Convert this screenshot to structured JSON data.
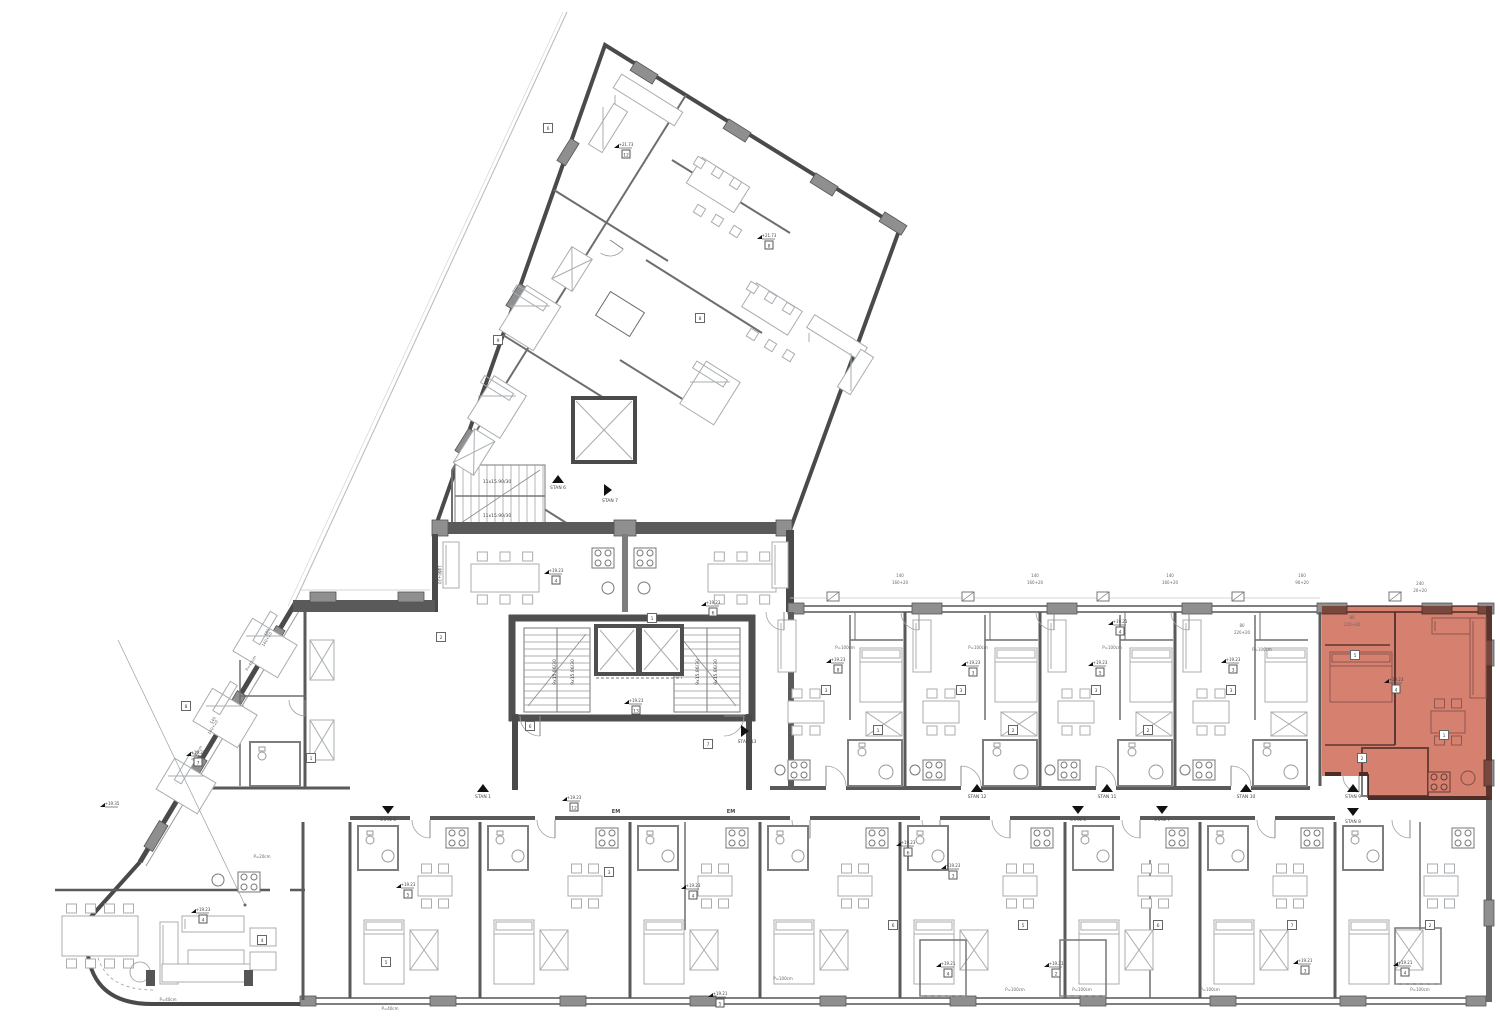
{
  "document": {
    "type": "architectural-floor-plan",
    "sheet_background": "#ffffff"
  },
  "colors": {
    "highlight_fill": "#cd6450",
    "wall_dark": "#4a4a4a",
    "wall_mid": "#6e6e6e",
    "pier_gray": "#8f8f8f",
    "furniture_line": "#a8adb1",
    "thin_line": "#9aa0a4",
    "text_color": "#444444"
  },
  "highlighted_unit": {
    "entry_label_up": "STAN 9",
    "entry_label_down": "STAN 8",
    "elevation": "+19.23",
    "room_box": "4"
  },
  "corridor_markers": [
    {
      "label": "STAN 3",
      "x": 388,
      "y": 806,
      "dir": "down"
    },
    {
      "label": "STAN 1",
      "x": 483,
      "y": 792,
      "dir": "up"
    },
    {
      "label": "STAN 13",
      "x": 741,
      "y": 731,
      "dir": "right"
    },
    {
      "label": "STAN 12",
      "x": 977,
      "y": 792,
      "dir": "up"
    },
    {
      "label": "STAN 5",
      "x": 1078,
      "y": 806,
      "dir": "down"
    },
    {
      "label": "STAN 11",
      "x": 1107,
      "y": 792,
      "dir": "up"
    },
    {
      "label": "STAN 7",
      "x": 1162,
      "y": 806,
      "dir": "down"
    },
    {
      "label": "STAN 10",
      "x": 1246,
      "y": 792,
      "dir": "up"
    },
    {
      "label": "STAN 9",
      "x": 1353,
      "y": 792,
      "dir": "up"
    },
    {
      "label": "STAN 8",
      "x": 1353,
      "y": 808,
      "dir": "down"
    },
    {
      "label": "STAN 6",
      "x": 558,
      "y": 483,
      "dir": "up"
    },
    {
      "label": "STAN 7",
      "x": 604,
      "y": 490,
      "dir": "right"
    }
  ],
  "elevation_markers": [
    {
      "text": "+21.73",
      "box": "12",
      "x": 618,
      "y": 147
    },
    {
      "text": "+21.73",
      "box": "8",
      "x": 761,
      "y": 238
    },
    {
      "text": "+19.23",
      "box": "4",
      "x": 548,
      "y": 573
    },
    {
      "text": "+19.23",
      "box": "6",
      "x": 705,
      "y": 605
    },
    {
      "text": "+19.23",
      "box": "13",
      "x": 628,
      "y": 703
    },
    {
      "text": "+19.23",
      "box": "12",
      "x": 566,
      "y": 800
    },
    {
      "text": "+19.23",
      "box": "5",
      "x": 400,
      "y": 887
    },
    {
      "text": "+19.23",
      "box": "4",
      "x": 685,
      "y": 888
    },
    {
      "text": "+19.23",
      "box": "6",
      "x": 900,
      "y": 845
    },
    {
      "text": "+19.23",
      "box": "3",
      "x": 945,
      "y": 868
    },
    {
      "text": "+19.23",
      "box": "8",
      "x": 830,
      "y": 662
    },
    {
      "text": "+19.23",
      "box": "3",
      "x": 965,
      "y": 665
    },
    {
      "text": "+19.23",
      "box": "5",
      "x": 1092,
      "y": 665
    },
    {
      "text": "+19.23",
      "box": "3",
      "x": 1225,
      "y": 662
    },
    {
      "text": "+19.23",
      "box": "4",
      "x": 1388,
      "y": 682
    },
    {
      "text": "+19.23",
      "box": "4",
      "x": 195,
      "y": 912
    },
    {
      "text": "+19.23",
      "box": "7",
      "x": 190,
      "y": 755
    },
    {
      "text": "+19.35",
      "box": "",
      "x": 104,
      "y": 806
    },
    {
      "text": "+19.21",
      "box": "4",
      "x": 1112,
      "y": 624
    },
    {
      "text": "+19.21",
      "box": "4",
      "x": 940,
      "y": 966
    },
    {
      "text": "+19.21",
      "box": "2",
      "x": 1048,
      "y": 966
    },
    {
      "text": "+19.21",
      "box": "3",
      "x": 1297,
      "y": 963
    },
    {
      "text": "+19.21",
      "box": "4",
      "x": 1397,
      "y": 965
    },
    {
      "text": "+19.21",
      "box": "5",
      "x": 712,
      "y": 996
    }
  ],
  "stair_labels": [
    {
      "text": "11x15.90/30",
      "x": 497,
      "y": 483,
      "rot": 0
    },
    {
      "text": "11x15.90/30",
      "x": 497,
      "y": 517,
      "rot": 0
    },
    {
      "text": "9x15.86/30",
      "x": 556,
      "y": 672,
      "rot": -90
    },
    {
      "text": "9x15.86/30",
      "x": 574,
      "y": 672,
      "rot": -90
    },
    {
      "text": "9x15.86/30",
      "x": 699,
      "y": 672,
      "rot": -90
    },
    {
      "text": "9x15.86/30",
      "x": 717,
      "y": 672,
      "rot": -90
    }
  ],
  "parapet_labels": [
    {
      "text": "P=100cm",
      "x": 845,
      "y": 649,
      "rot": 0
    },
    {
      "text": "P=100cm",
      "x": 978,
      "y": 649,
      "rot": 0
    },
    {
      "text": "P=100cm",
      "x": 1112,
      "y": 649,
      "rot": 0
    },
    {
      "text": "P=100cm",
      "x": 1262,
      "y": 651,
      "rot": 0
    },
    {
      "text": "P=100cm",
      "x": 783,
      "y": 980,
      "rot": 0
    },
    {
      "text": "P=100cm",
      "x": 1015,
      "y": 991,
      "rot": 0
    },
    {
      "text": "P=100cm",
      "x": 1082,
      "y": 991,
      "rot": 0
    },
    {
      "text": "P=100cm",
      "x": 1210,
      "y": 991,
      "rot": 0
    },
    {
      "text": "P=100cm",
      "x": 1420,
      "y": 991,
      "rot": 0
    },
    {
      "text": "P=40cm",
      "x": 390,
      "y": 1010,
      "rot": 0
    },
    {
      "text": "P=40cm",
      "x": 168,
      "y": 1001,
      "rot": 0
    },
    {
      "text": "P=20cm",
      "x": 262,
      "y": 858,
      "rot": 0
    },
    {
      "text": "P=40cm",
      "x": 252,
      "y": 664,
      "rot": -59
    },
    {
      "text": "P=40cm",
      "x": 198,
      "y": 754,
      "rot": -59
    }
  ],
  "dimension_stacks": [
    {
      "top": "140",
      "bottom": "160+20",
      "x": 900,
      "y": 580,
      "rot": 0
    },
    {
      "top": "140",
      "bottom": "160+20",
      "x": 1035,
      "y": 580,
      "rot": 0
    },
    {
      "top": "140",
      "bottom": "160+20",
      "x": 1170,
      "y": 580,
      "rot": 0
    },
    {
      "top": "160",
      "bottom": "90+20",
      "x": 1302,
      "y": 580,
      "rot": 0
    },
    {
      "top": "240",
      "bottom": "20+20",
      "x": 1420,
      "y": 588,
      "rot": 0
    },
    {
      "top": "180",
      "bottom": "140+20",
      "x": 268,
      "y": 636,
      "rot": -59
    },
    {
      "top": "140",
      "bottom": "140+20",
      "x": 214,
      "y": 724,
      "rot": -59
    },
    {
      "top": "140",
      "bottom": "160+20",
      "x": 438,
      "y": 572,
      "rot": 90
    },
    {
      "top": "80",
      "bottom": "220+20",
      "x": 1242,
      "y": 630,
      "rot": 0
    },
    {
      "top": "80",
      "bottom": "220+20",
      "x": 1352,
      "y": 622,
      "rot": 0
    }
  ],
  "room_numbers": [
    {
      "n": "1",
      "x": 311,
      "y": 758
    },
    {
      "n": "5",
      "x": 386,
      "y": 962
    },
    {
      "n": "2",
      "x": 441,
      "y": 637
    },
    {
      "n": "6",
      "x": 530,
      "y": 726
    },
    {
      "n": "3",
      "x": 609,
      "y": 872
    },
    {
      "n": "1",
      "x": 652,
      "y": 618
    },
    {
      "n": "7",
      "x": 708,
      "y": 744
    },
    {
      "n": "3",
      "x": 826,
      "y": 690
    },
    {
      "n": "3",
      "x": 961,
      "y": 690
    },
    {
      "n": "3",
      "x": 1096,
      "y": 690
    },
    {
      "n": "3",
      "x": 1231,
      "y": 690
    },
    {
      "n": "5",
      "x": 1355,
      "y": 655
    },
    {
      "n": "1",
      "x": 1444,
      "y": 735
    },
    {
      "n": "6",
      "x": 893,
      "y": 925
    },
    {
      "n": "5",
      "x": 1023,
      "y": 925
    },
    {
      "n": "6",
      "x": 1158,
      "y": 925
    },
    {
      "n": "7",
      "x": 1292,
      "y": 925
    },
    {
      "n": "2",
      "x": 1430,
      "y": 925
    },
    {
      "n": "8",
      "x": 186,
      "y": 706
    },
    {
      "n": "4",
      "x": 262,
      "y": 940
    },
    {
      "n": "2",
      "x": 1362,
      "y": 758
    },
    {
      "n": "1",
      "x": 878,
      "y": 730
    },
    {
      "n": "2",
      "x": 1013,
      "y": 730
    },
    {
      "n": "2",
      "x": 1148,
      "y": 730
    },
    {
      "n": "6",
      "x": 548,
      "y": 128
    },
    {
      "n": "8",
      "x": 700,
      "y": 318
    },
    {
      "n": "9",
      "x": 498,
      "y": 340
    }
  ],
  "em_labels": [
    {
      "text": "EM",
      "x": 616,
      "y": 813
    },
    {
      "text": "EM",
      "x": 731,
      "y": 813
    }
  ]
}
